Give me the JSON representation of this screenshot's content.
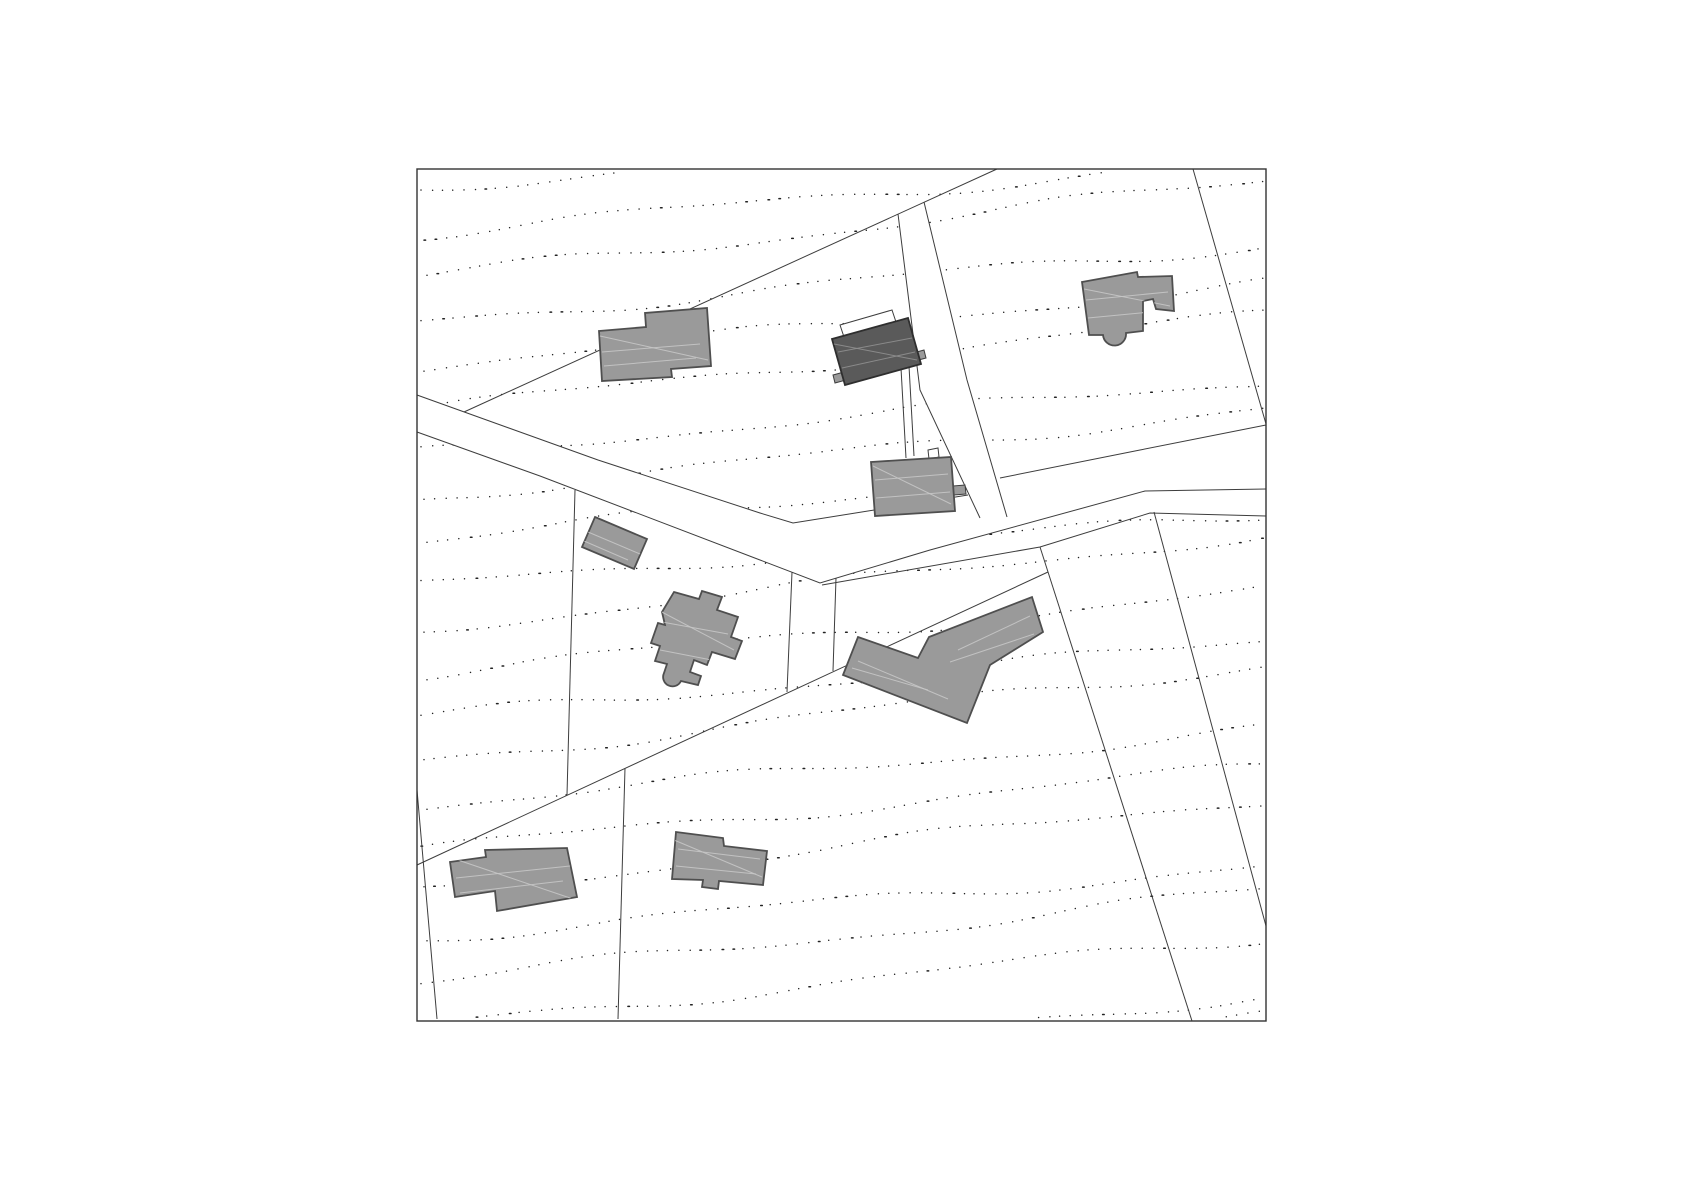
{
  "plan": {
    "canvas": {
      "width": 1684,
      "height": 1190,
      "background": "#ffffff"
    },
    "frame": {
      "x": 417,
      "y": 169,
      "width": 849,
      "height": 852,
      "stroke": "#333333",
      "stroke_width": 1.4
    },
    "colors": {
      "line": "#3d3d3d",
      "road_fill": "#ffffff",
      "building_fill": "#9a9a9a",
      "building_stroke": "#4f4f4f",
      "highlight_fill": "#5a5a5a",
      "highlight_stroke": "#2e2e2e",
      "streak": "#c7c7c7",
      "highlight_streak": "#8f8f8f",
      "dot": "#222222",
      "white_fill": "#ffffff"
    },
    "contours": {
      "rows": 22,
      "y_start": 190,
      "spacing": 44,
      "slope": -0.1,
      "amp": 5.5,
      "wavelength": 95,
      "phase_step": 1.9,
      "dot_step": 9.5,
      "dot_width": 1.5
    },
    "roads": [
      {
        "name": "main-road",
        "fill_path": "M417,395 L598,460 L760,513 L793,523 L960,497 L1013,473 L1140,450 L1266,425 L1266,489 L1145,491 L930,550 L820,583 L760,560 L540,476 L417,432 Z",
        "edge_paths": [
          "M417,395 L598,460 L760,513 L793,523 L968,495",
          "M1000,478 L1140,450 L1266,425",
          "M417,432 L540,476 L760,560 L820,583 L930,550 L1145,491 L1266,489"
        ]
      },
      {
        "name": "access-lane",
        "fill_path": "M898,214 L924,202 L967,380 L1007,517 L980,518 L920,390 Z",
        "edge_paths": [
          "M898,214 L920,390 L980,518",
          "M924,202 L967,380 L1007,517"
        ]
      }
    ],
    "parcel_lines": [
      {
        "name": "parcel-line-north-diagonal",
        "path": "M997,169 L464,412"
      },
      {
        "name": "parcel-line-northeast-diagonal",
        "path": "M1193,169 L1266,424"
      },
      {
        "name": "parcel-line-below-road",
        "path": "M822,585 L1040,547 L1150,513 L1266,516"
      },
      {
        "name": "parcel-line-southeast-steep",
        "path": "M1040,547 L1192,1021"
      },
      {
        "name": "parcel-line-east-steep",
        "path": "M1154,512 L1266,926"
      },
      {
        "name": "parcel-line-southwest-diagonal",
        "path": "M417,865 L1048,572"
      },
      {
        "name": "parcel-line-center-short-west",
        "path": "M792,572 L787,692"
      },
      {
        "name": "parcel-line-center-short-east",
        "path": "M836,578 L833,671"
      },
      {
        "name": "parcel-line-center-vertical",
        "path": "M575,490 L567,795"
      },
      {
        "name": "parcel-line-south-vertical",
        "path": "M625,768 L618,1019"
      },
      {
        "name": "parcel-line-southwest-corner",
        "path": "M417,790 L437,1019"
      }
    ],
    "annexes": [
      {
        "name": "terrace-outline",
        "path": "M840,325 L892,310 L896,322 L844,337 Z",
        "fill": "#ffffff",
        "stroke": true
      },
      {
        "name": "driveway-line-west",
        "path": "M901,368 L906,458",
        "fill": "none",
        "stroke": true
      },
      {
        "name": "driveway-line-east",
        "path": "M909,366 L914,456",
        "fill": "none",
        "stroke": true
      },
      {
        "name": "annex-tab-west",
        "path": "M833,375 L844,372 L846,380 L835,383 Z",
        "fill": "#9a9a9a",
        "stroke": true
      },
      {
        "name": "annex-tab-east",
        "path": "M913,353 L924,350 L926,358 L915,361 Z",
        "fill": "#9a9a9a",
        "stroke": true
      },
      {
        "name": "annex-tab-south",
        "path": "M953,486 L965,485 L966,494 L954,495 Z",
        "fill": "#9a9a9a",
        "stroke": true
      },
      {
        "name": "entrance-outline",
        "path": "M928,450 L938,448 L939,457 L929,459 Z",
        "fill": "#ffffff",
        "stroke": true
      }
    ],
    "buildings": [
      {
        "name": "building-northwest",
        "role": "normal",
        "path": "M599,331 L646,327 L645,313 L707,308 L711,366 L671,369 L672,377 L602,381 Z",
        "streaks": [
          [
            602,
            352,
            700,
            344
          ],
          [
            604,
            366,
            696,
            358
          ],
          [
            600,
            336,
            708,
            360
          ]
        ]
      },
      {
        "name": "building-highlighted",
        "role": "highlight",
        "path": "M832,339 L908,318 L921,364 L845,385 Z",
        "streaks": [
          [
            838,
            352,
            912,
            338
          ],
          [
            842,
            368,
            915,
            352
          ],
          [
            834,
            344,
            917,
            360
          ]
        ]
      },
      {
        "name": "building-northeast",
        "role": "normal",
        "path": "M1082,282 L1137,272 L1138,277 L1172,276 L1174,311 L1156,309 L1153,299 L1143,301 L1143,331 L1126,333 A 11 11 0 0 1 1103,335 L1089,335 Z",
        "streaks": [
          [
            1086,
            300,
            1168,
            292
          ],
          [
            1088,
            318,
            1150,
            312
          ],
          [
            1084,
            289,
            1170,
            306
          ]
        ]
      },
      {
        "name": "building-annex-central",
        "role": "normal",
        "path": "M595,517 L647,539 L634,569 L582,547 Z",
        "streaks": [
          [
            588,
            532,
            640,
            554
          ],
          [
            584,
            541,
            628,
            560
          ]
        ]
      },
      {
        "name": "building-central",
        "role": "normal",
        "path": "M674,592 L699,599 L702,591 L722,597 L717,610 L738,617 L731,637 L742,641 L735,659 L712,652 L707,665 L694,660 L690,672 L701,676 L698,685 L681,681 A 8.5 8.5 0 0 1 664,673 L667,664 L655,661 L660,646 L651,643 L658,623 L665,625 L662,612 Z",
        "streaks": [
          [
            662,
            622,
            728,
            634
          ],
          [
            660,
            650,
            722,
            662
          ],
          [
            658,
            610,
            734,
            650
          ]
        ]
      },
      {
        "name": "building-east-large",
        "role": "normal",
        "path": "M858,637 L918,658 L929,637 L1032,597 L1043,632 L990,665 L967,723 L843,675 Z",
        "streaks": [
          [
            858,
            661,
            948,
            699
          ],
          [
            852,
            668,
            928,
            690
          ],
          [
            958,
            650,
            1030,
            616
          ],
          [
            950,
            662,
            1034,
            634
          ]
        ]
      },
      {
        "name": "building-center-north",
        "role": "normal",
        "path": "M871,462 L951,457 L955,511 L875,516 Z",
        "streaks": [
          [
            875,
            480,
            948,
            474
          ],
          [
            876,
            498,
            950,
            492
          ],
          [
            873,
            466,
            951,
            504
          ]
        ]
      },
      {
        "name": "building-southwest",
        "role": "normal",
        "path": "M450,862 L486,857 L485,850 L567,848 L577,897 L497,911 L495,891 L455,897 Z",
        "streaks": [
          [
            456,
            878,
            570,
            866
          ],
          [
            460,
            893,
            563,
            881
          ],
          [
            452,
            858,
            573,
            899
          ]
        ]
      },
      {
        "name": "building-south",
        "role": "normal",
        "path": "M676,832 L723,838 L724,846 L767,851 L763,885 L719,881 L718,889 L702,887 L703,880 L672,879 Z",
        "streaks": [
          [
            678,
            849,
            760,
            859
          ],
          [
            676,
            866,
            756,
            874
          ],
          [
            674,
            840,
            762,
            877
          ]
        ]
      }
    ]
  }
}
